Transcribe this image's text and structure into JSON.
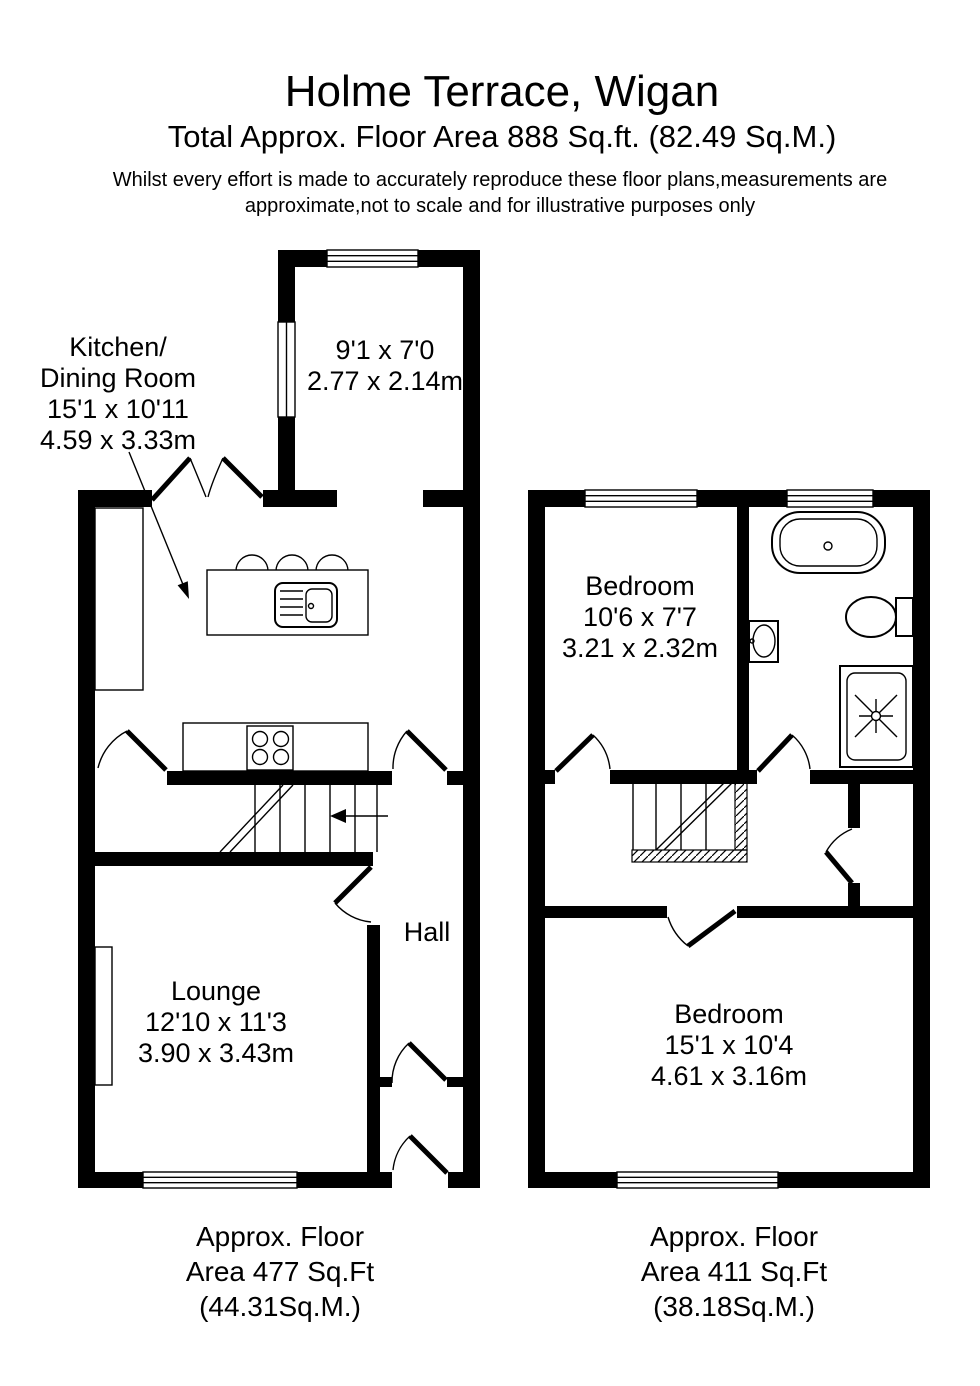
{
  "header": {
    "title": "Holme Terrace, Wigan",
    "subtitle": "Total Approx. Floor Area 888 Sq.ft. (82.49 Sq.M.)",
    "disclaimer_line1": "Whilst every effort is made to accurately reproduce these floor plans,measurements are",
    "disclaimer_line2": "approximate,not to scale and for illustrative purposes only"
  },
  "ground_floor": {
    "kitchen_dining": {
      "name_line1": "Kitchen/",
      "name_line2": "Dining Room",
      "size_imperial": "15'1 x 10'11",
      "size_metric": "4.59 x 3.33m"
    },
    "rear_room": {
      "size_imperial": "9'1 x 7'0",
      "size_metric": "2.77 x 2.14m"
    },
    "lounge": {
      "name": "Lounge",
      "size_imperial": "12'10 x 11'3",
      "size_metric": "3.90 x 3.43m"
    },
    "hall": {
      "name": "Hall"
    },
    "floor_area": {
      "line1": "Approx. Floor",
      "line2": "Area 477 Sq.Ft",
      "line3": "(44.31Sq.M.)"
    }
  },
  "first_floor": {
    "bedroom_front": {
      "name": "Bedroom",
      "size_imperial": "10'6 x 7'7",
      "size_metric": "3.21 x 2.32m"
    },
    "bedroom_back": {
      "name": "Bedroom",
      "size_imperial": "15'1 x 10'4",
      "size_metric": "4.61 x 3.16m"
    },
    "floor_area": {
      "line1": "Approx. Floor",
      "line2": "Area 411 Sq.Ft",
      "line3": "(38.18Sq.M.)"
    }
  },
  "colors": {
    "wall": "#000000",
    "text": "#000000",
    "background": "#ffffff"
  }
}
